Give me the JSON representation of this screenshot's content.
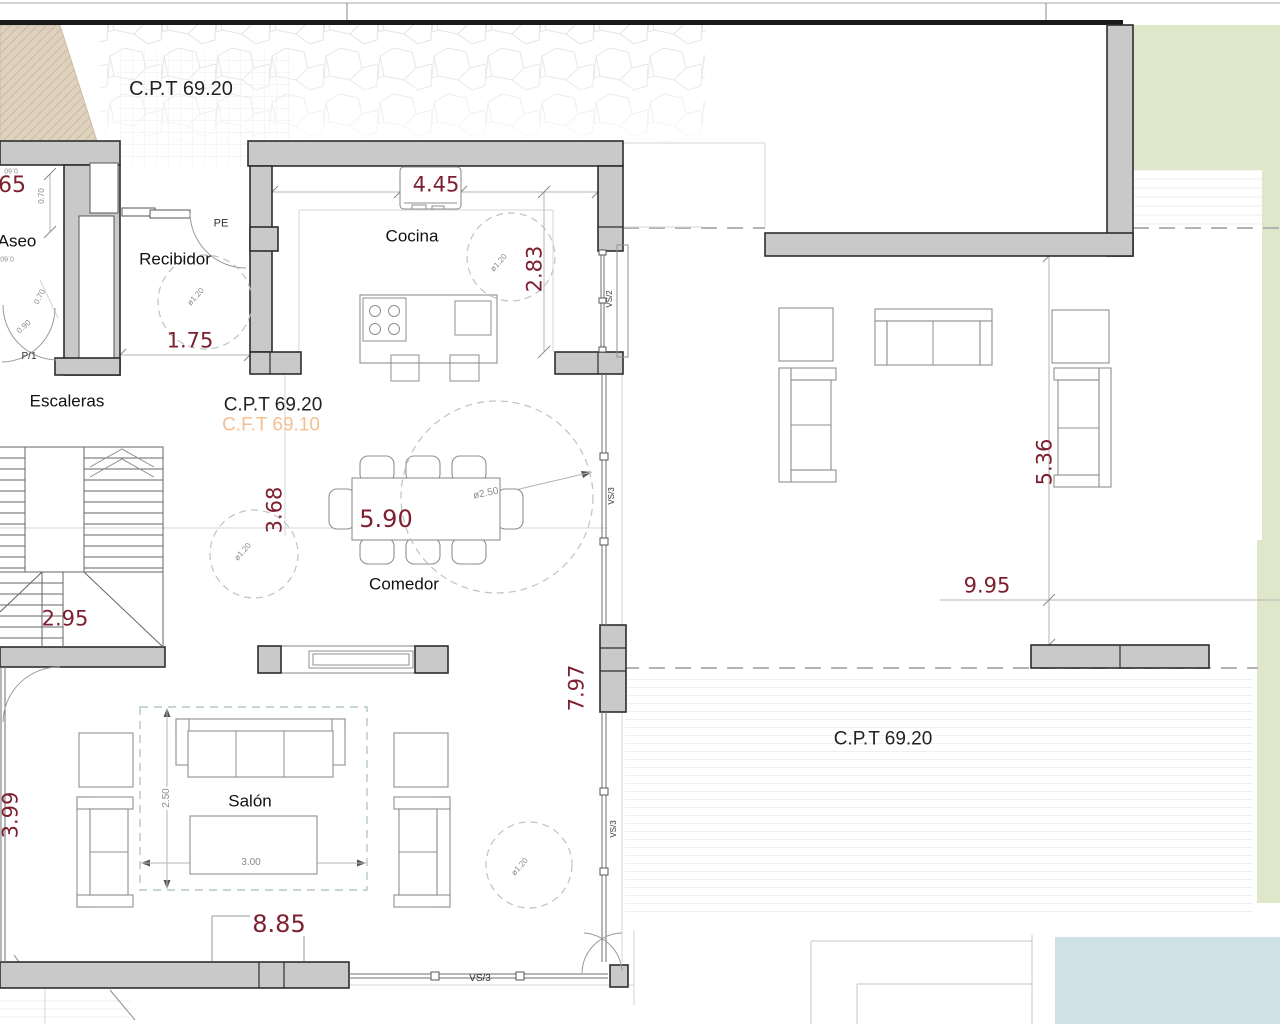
{
  "labels": {
    "cpt_top": "C.P.T 69.20",
    "cpt_mid": "C.P.T 69.20",
    "cft_mid": "C.F.T 69.10",
    "cpt_terrace": "C.P.T 69.20"
  },
  "rooms": {
    "aseo": "Aseo",
    "recibidor": "Recibidor",
    "cocina": "Cocina",
    "escaleras": "Escaleras",
    "comedor": "Comedor",
    "salon": "Salón"
  },
  "dims_red": {
    "aseo_width": "65",
    "cocina_width": "4.45",
    "cocina_depth": "2.83",
    "recibidor_width": "1.75",
    "comedor_left": "3.68",
    "comedor_width": "5.90",
    "escaleras_width": "2.95",
    "salon_height": "7.97",
    "salon_width": "8.85",
    "salon_left": "3.99",
    "terrace_depth": "5.36",
    "terrace_width": "9.95"
  },
  "dims_small": {
    "d070": "0.70",
    "d090": "0.90",
    "d060": "0.60",
    "d250": "2.50",
    "d300": "3.00",
    "dia120": "ø1.20",
    "dia250": "ø2.50"
  },
  "openings": {
    "pe": "PE",
    "p1": "P/1",
    "vs2": "VS/2",
    "vs3": "VS/3"
  },
  "colors": {
    "wall_fill": "#c9c9c9",
    "wall_stroke": "#2e2e2e",
    "dim_red": "#7d1f2e",
    "cft_orange": "#f4c090",
    "green_area": "#dfe7ca",
    "pool_blue": "#cfe1e4",
    "beige_area": "#ded2bf",
    "teal_hatch": "#a8d4c0",
    "dashed_circle": "#b9c6c2"
  }
}
